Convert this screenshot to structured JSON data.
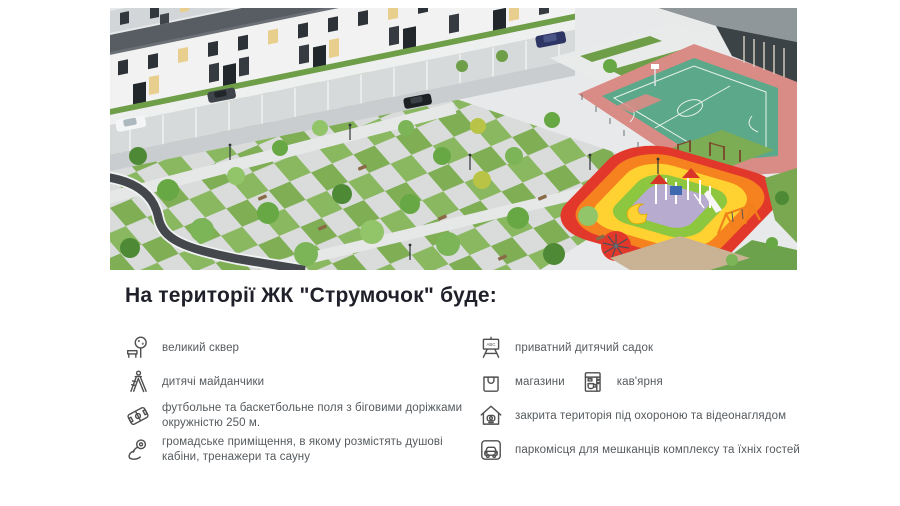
{
  "section": {
    "title": "На території ЖК \"Струмочок\" буде:"
  },
  "features": {
    "left": [
      {
        "icon": "park-icon",
        "label": "великий сквер"
      },
      {
        "icon": "playground-slide-icon",
        "label": "дитячі майданчики"
      },
      {
        "icon": "sports-field-icon",
        "label": "футбольне та баскетбольне поля з біговими доріжками окружністю 250 м."
      },
      {
        "icon": "gym-arm-icon",
        "label": "громадське приміщення, в якому розмістять душові кабіни, тренажери та сауну"
      }
    ],
    "right": [
      {
        "icon": "kindergarten-board-icon",
        "label": "приватний дитячий садок",
        "icon_text": "ABC"
      },
      {
        "icon": "shopping-bag-icon",
        "label": "магазини"
      },
      {
        "icon": "coffee-machine-icon",
        "label": "кав'ярня"
      },
      {
        "icon": "secured-house-icon",
        "label": "закрита територія під охороною та відеонаглядом"
      },
      {
        "icon": "parking-car-icon",
        "label": "паркомісця для мешканців комплексу та їхніх гостей"
      }
    ]
  },
  "hero": {
    "colors": {
      "pavement": "#e7e9ea",
      "grass": "#7fae55",
      "track_asphalt": "#44484c",
      "court_surface": "#5ca88b",
      "court_border": "#d98b85",
      "playground_red": "#e2382c",
      "playground_orange": "#f5821f",
      "playground_yellow": "#ffd231",
      "playground_green": "#8dc63f",
      "playground_center": "#b7abcf",
      "roof": "#575d62",
      "facade": "#f1f2f1"
    }
  }
}
